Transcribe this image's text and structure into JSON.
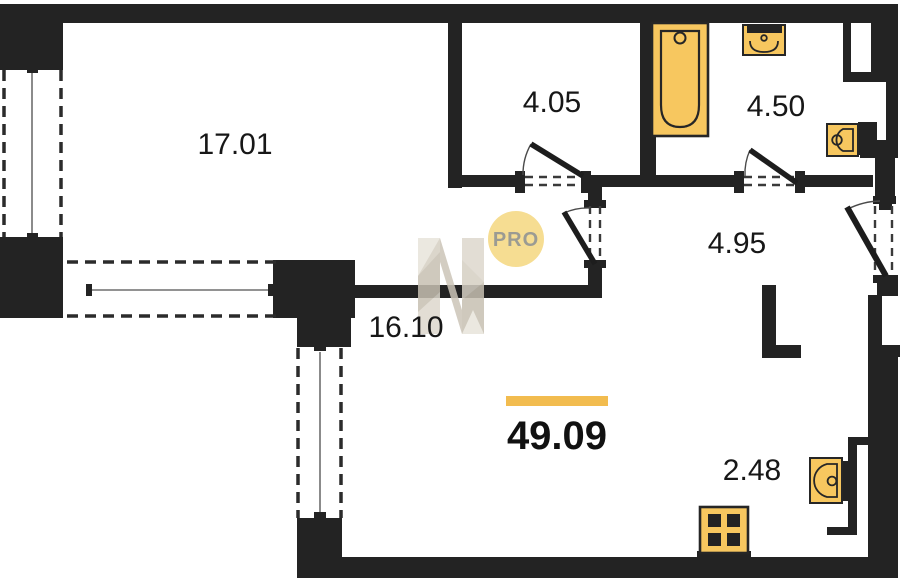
{
  "plan": {
    "title": "apartment-floor-plan",
    "total_area": {
      "value": "49.09",
      "accent_bar_color": "#F2BC4F"
    },
    "rooms": [
      {
        "name": "living-room",
        "area": "17.01"
      },
      {
        "name": "hall-top",
        "area": "4.05"
      },
      {
        "name": "bathroom",
        "area": "4.50"
      },
      {
        "name": "hallway",
        "area": "4.95"
      },
      {
        "name": "main-room",
        "area": "16.10"
      },
      {
        "name": "kitchen-zone",
        "area": "2.48"
      }
    ],
    "watermark": {
      "logo_text": "PRO",
      "logo_circle_color": "#F6DD92",
      "logo_text_color": "#9B9B93",
      "monogram": "N",
      "monogram_colors": [
        "#E8E4DB",
        "#D5CFC3",
        "#C7C0B2",
        "#DDD8CD"
      ]
    },
    "colors": {
      "wall": "#232323",
      "background": "#FFFFFF",
      "fixture_fill": "#F7C75F",
      "fixture_stroke": "#262626",
      "glass_line": "#6E6E6E"
    },
    "fixtures": [
      "bathtub",
      "bathroom-sink",
      "toilet",
      "kitchen-sink",
      "stove"
    ]
  }
}
